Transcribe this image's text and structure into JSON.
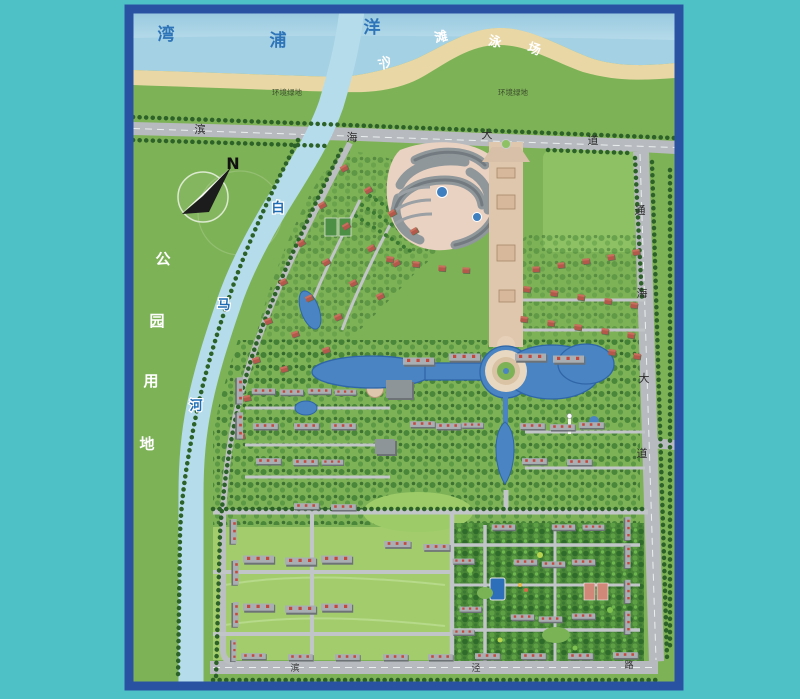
{
  "colors": {
    "background": "#4ec1c7",
    "frame": "#2952a3",
    "sea": "#a5d1e4",
    "sand": "#e9d8a6",
    "grass": "#7eb257",
    "river": "#b5dcea",
    "lake": "#4a84c2",
    "road": "#b7babe"
  },
  "compass": {
    "north_label": "N"
  },
  "sea": {
    "chars": [
      "湾",
      "浦",
      "洋"
    ]
  },
  "beach": {
    "chars": [
      "沙",
      "滩",
      "泳",
      "场"
    ]
  },
  "buffer_green": {
    "left_label": "环境绿地",
    "right_label": "环境绿地"
  },
  "roads": {
    "binhai_avenue": {
      "chars": [
        "滨",
        "海",
        "大",
        "道"
      ]
    },
    "tonghai_avenue": {
      "chars": [
        "通",
        "海",
        "大",
        "道"
      ]
    },
    "binjing_road": {
      "chars": [
        "滨",
        "泾",
        "路"
      ]
    }
  },
  "river": {
    "chars": [
      "白",
      "马",
      "河"
    ]
  },
  "park": {
    "chars": [
      "公",
      "园",
      "用",
      "地"
    ]
  }
}
